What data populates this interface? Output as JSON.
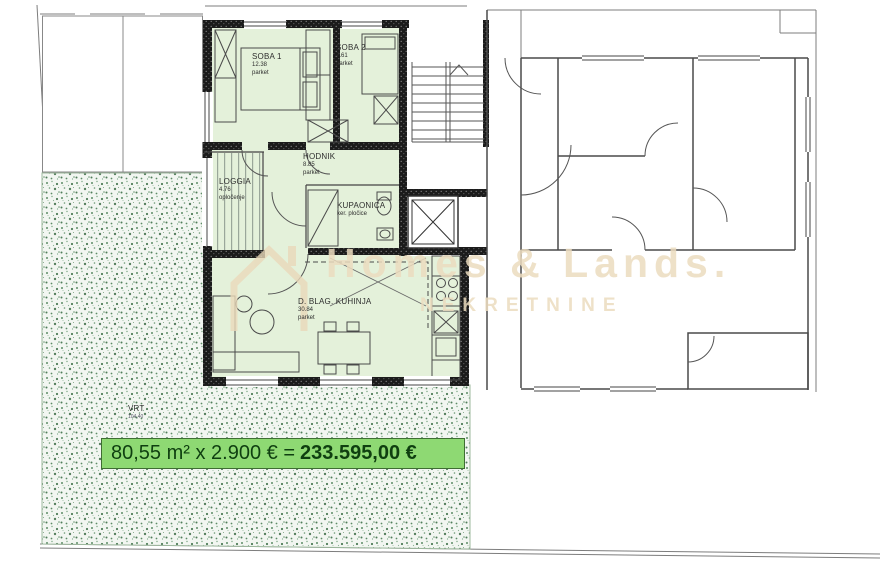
{
  "watermark": {
    "brand": "Homes & Lands.",
    "subtitle": "NEKRETNINE",
    "logo": "house-outline-icon",
    "color": "#ecdcbf"
  },
  "banner": {
    "formula": "80,55 m² x 2.900 € = ",
    "total": "233.595,00 €",
    "bg": "#8ed973",
    "text_color": "#0f3f10"
  },
  "rooms": [
    {
      "name": "SOBA 1",
      "area": "12.38",
      "floor": "parket"
    },
    {
      "name": "SOBA 2",
      "area": "7.61",
      "floor": "parket"
    },
    {
      "name": "HODNIK",
      "area": "8.85",
      "floor": "parket"
    },
    {
      "name": "LOGGIA",
      "area": "4.76",
      "floor": "opločenje"
    },
    {
      "name": "KUPAONICA",
      "floor": "ker. pločice"
    },
    {
      "name": "D. BLAG. KUHINJA",
      "area": "30.84",
      "floor": "parket"
    },
    {
      "name": "VRT",
      "area": "104,40"
    }
  ],
  "colors": {
    "apartment_fill": "#e4f1da",
    "wall": "#1b1b1b",
    "garden_base": "#f2f6f1",
    "garden_dots": "#5d8c66",
    "line": "#4a4a4a"
  }
}
